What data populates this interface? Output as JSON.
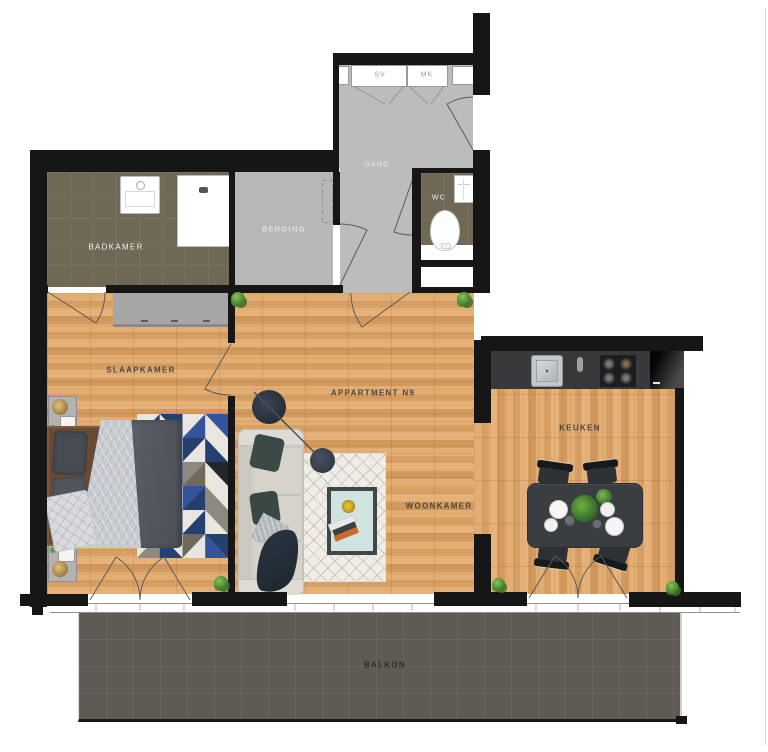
{
  "title": "APPARTMENT  N9",
  "rooms": {
    "badkamer": "BADKAMER",
    "berging": "BERGING",
    "gang": "GANG",
    "wc": "WC",
    "slaapkamer": "SLAAPKAMER",
    "woonkamer": "WOONKAMER",
    "keuken": "KEUKEN",
    "balkon": "BALKON"
  },
  "closets": {
    "sv": "SV",
    "mk": "MK"
  },
  "colors": {
    "wall": "#161616",
    "wood_floor": "#dca76a",
    "wet_room_tile": "#6e6855",
    "hall_floor": "#bcbcbc",
    "balcony_tile": "#5f5a53",
    "counter": "#39393b",
    "dining_table": "#3b3e40",
    "couch": "#d8d5cc",
    "duvet": "#585c62",
    "rug_palette": [
      "#e9e6df",
      "#24406f",
      "#33539c",
      "#8d897e",
      "#23262b",
      "#6f695c"
    ]
  }
}
